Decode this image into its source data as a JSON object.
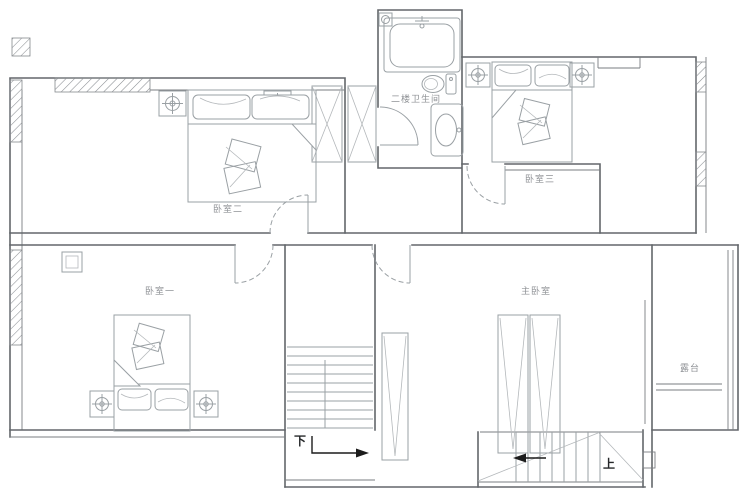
{
  "labels": {
    "bedroom_one": "卧室一",
    "bedroom_two": "卧室二",
    "bedroom_three": "卧室三",
    "master_bedroom": "主卧室",
    "second_floor_bathroom": "二楼卫生间",
    "terrace": "露台",
    "stair_down": "下",
    "stair_up": "上"
  },
  "colors": {
    "background": "#ffffff",
    "wall_line": "#63676b",
    "fixture_line": "#9aa0a4",
    "label_text": "#8f9296",
    "stair_text": "#26282a",
    "arrow": "#1c1c1c"
  }
}
